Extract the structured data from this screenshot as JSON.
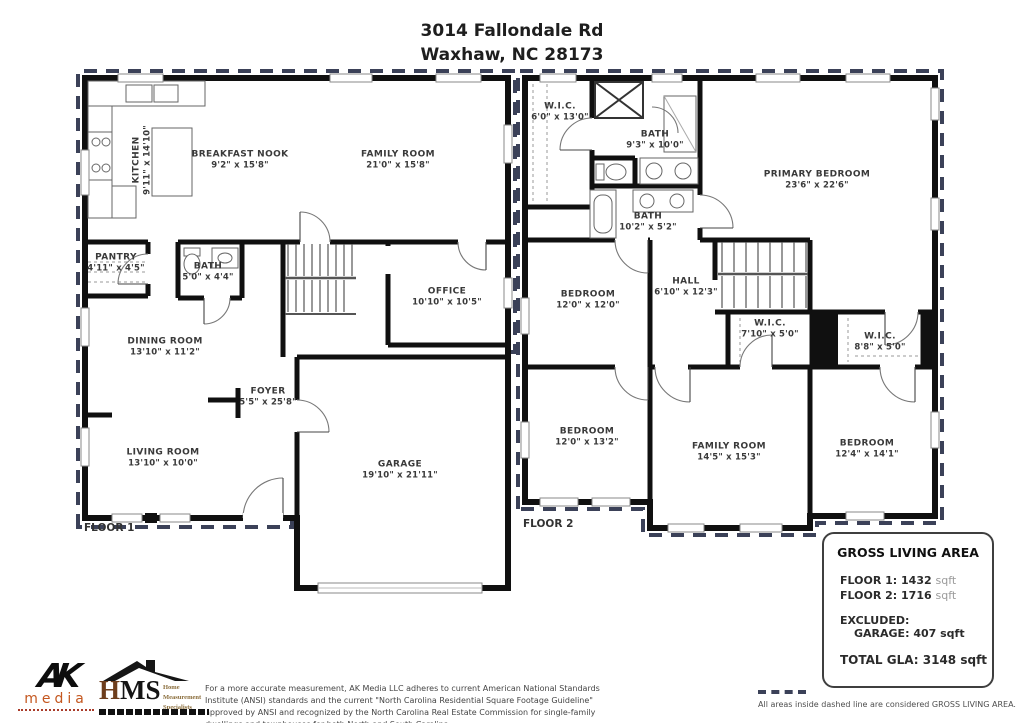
{
  "title": {
    "line1": "3014 Fallondale Rd",
    "line2": "Waxhaw, NC  28173"
  },
  "floors": [
    {
      "label": "FLOOR 1",
      "rooms": [
        {
          "name": "KITCHEN",
          "dims": "9'11\" x 14'10\""
        },
        {
          "name": "BREAKFAST NOOK",
          "dims": "9'2\" x 15'8\""
        },
        {
          "name": "FAMILY ROOM",
          "dims": "21'0\" x 15'8\""
        },
        {
          "name": "PANTRY",
          "dims": "4'11\" x 4'5\""
        },
        {
          "name": "BATH",
          "dims": "5'0\" x 4'4\""
        },
        {
          "name": "OFFICE",
          "dims": "10'10\" x 10'5\""
        },
        {
          "name": "DINING ROOM",
          "dims": "13'10\" x 11'2\""
        },
        {
          "name": "FOYER",
          "dims": "5'5\" x 25'8\""
        },
        {
          "name": "LIVING ROOM",
          "dims": "13'10\" x 10'0\""
        },
        {
          "name": "GARAGE",
          "dims": "19'10\" x 21'11\""
        }
      ]
    },
    {
      "label": "FLOOR 2",
      "rooms": [
        {
          "name": "W.I.C.",
          "dims": "6'0\" x 13'0\""
        },
        {
          "name": "BATH",
          "dims": "9'3\" x 10'0\""
        },
        {
          "name": "BATH",
          "dims": "10'2\" x 5'2\""
        },
        {
          "name": "PRIMARY BEDROOM",
          "dims": "23'6\" x 22'6\""
        },
        {
          "name": "BEDROOM",
          "dims": "12'0\" x 12'0\""
        },
        {
          "name": "HALL",
          "dims": "6'10\" x 12'3\""
        },
        {
          "name": "W.I.C.",
          "dims": "7'10\" x 5'0\""
        },
        {
          "name": "W.I.C.",
          "dims": "8'8\" x 5'0\""
        },
        {
          "name": "BEDROOM",
          "dims": "12'0\" x 13'2\""
        },
        {
          "name": "FAMILY ROOM",
          "dims": "14'5\" x 15'3\""
        },
        {
          "name": "BEDROOM",
          "dims": "12'4\" x 14'1\""
        }
      ]
    }
  ],
  "gla": {
    "title": "GROSS LIVING AREA",
    "lines": [
      {
        "label": "FLOOR 1:",
        "value": "1432",
        "unit": "sqft"
      },
      {
        "label": "FLOOR 2:",
        "value": "1716",
        "unit": "sqft"
      }
    ],
    "excluded_label": "EXCLUDED:",
    "excluded_item": {
      "label": "GARAGE:",
      "value": "407",
      "unit": "sqft"
    },
    "total": {
      "label": "TOTAL GLA:",
      "value": "3148",
      "unit": "sqft"
    }
  },
  "legend": {
    "text": "All areas inside dashed line are considered GROSS LIVING AREA."
  },
  "footer": {
    "disclaimer": "For a more accurate measurement, AK Media LLC adheres to current American National Standards Institute (ANSI) standards and the current \"North Carolina Residential Square Footage Guideline\" approved by ANSI and recognized by the North Carolina Real Estate Commission for single-family dwellings and townhouses for both North and South Carolina."
  },
  "logos": {
    "ak_mark": "AK",
    "ak_media": "media",
    "hms_h": "H",
    "hms_ms": "MS",
    "hms_tagline_1": "Home",
    "hms_tagline_2": "Measurement",
    "hms_tagline_3": "Specialists"
  },
  "colors": {
    "wall": "#101010",
    "gla_dashed_line": "#3b4158",
    "ak_accent": "#c4571f",
    "hms_gold": "#8a6d3b"
  }
}
